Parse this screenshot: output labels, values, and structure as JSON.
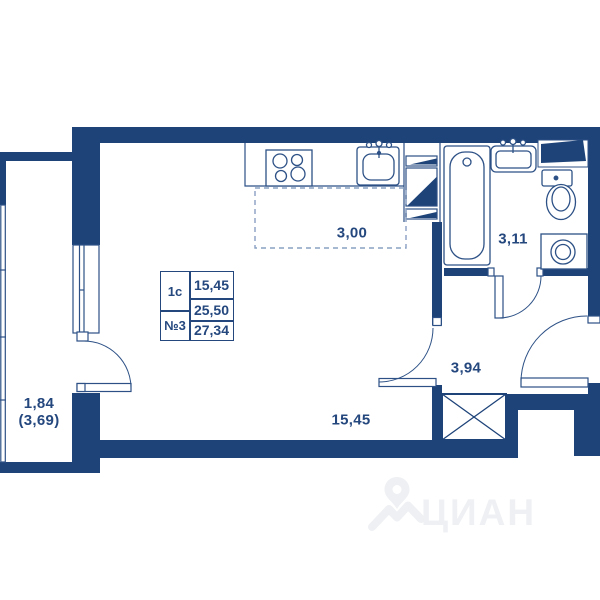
{
  "unit_info": {
    "type": "1с",
    "number": "№3",
    "living_area": "15,45",
    "area_without_balcony": "25,50",
    "total_area": "27,34"
  },
  "dimensions": {
    "kitchen_zone": "3,00",
    "bathroom": "3,11",
    "hallway": "3,94",
    "main_room": "15,45",
    "balcony": "1,84",
    "balcony_full": "(3,69)"
  },
  "watermark": {
    "brand": "ЦИАН"
  },
  "colors": {
    "wall": "#1e4379",
    "outline": "#2d5186",
    "text": "#24477e",
    "dashed_line": "#8aa0c2",
    "watermark": "#eef0f3",
    "background": "#ffffff"
  }
}
